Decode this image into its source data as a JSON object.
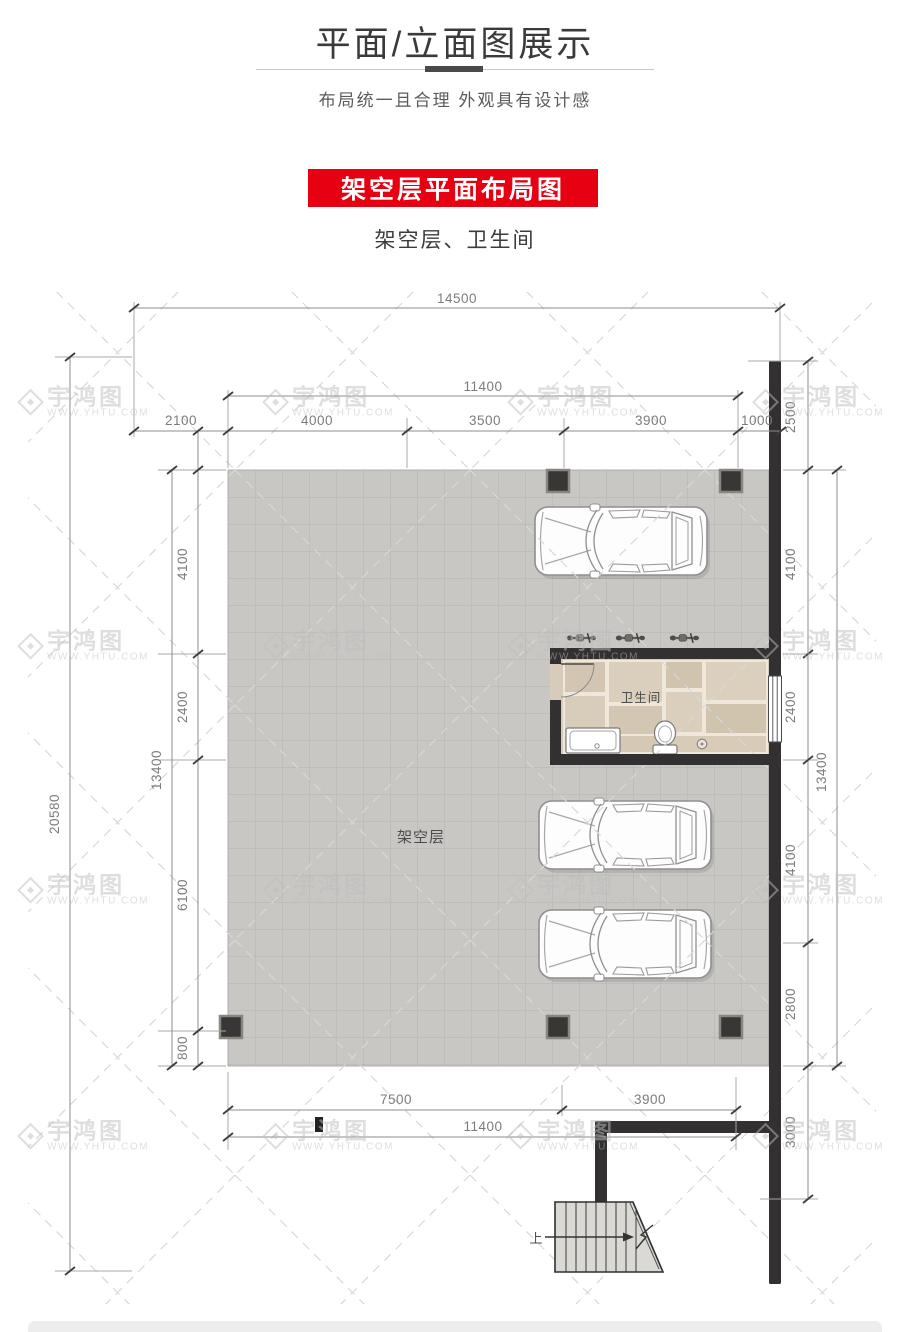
{
  "header": {
    "title": "平面/立面图展示",
    "subtitle": "布局统一且合理  外观具有设计感",
    "banner": "架空层平面布局图",
    "caption": "架空层、卫生间"
  },
  "plan": {
    "labels": {
      "room": "架空层",
      "bathroom": "卫生间",
      "stairs_up": "上"
    },
    "dims": {
      "total_width": "14500",
      "top_inner_width": "11400",
      "top_segments": [
        "2100",
        "4000",
        "3500",
        "3900",
        "1000"
      ],
      "total_height": "20580",
      "left_height": "13400",
      "left_segments": [
        "4100",
        "2400",
        "6100",
        "800"
      ],
      "right_offset_top": "2500",
      "right_segments": [
        "4100",
        "2400",
        "4100",
        "2800"
      ],
      "right_height": "13400",
      "right_offset_bottom": "3000",
      "bottom_segments": [
        "7500",
        "3900"
      ],
      "bottom_inner_width": "11400"
    }
  },
  "watermark": {
    "brand": "宇鸿图",
    "url": "WWW.YHTU.COM"
  },
  "colors": {
    "accent_red": "#e60012",
    "wall": "#323031",
    "slab_tile": "#c8c7c3",
    "bath_tile": "#d7ccba"
  }
}
